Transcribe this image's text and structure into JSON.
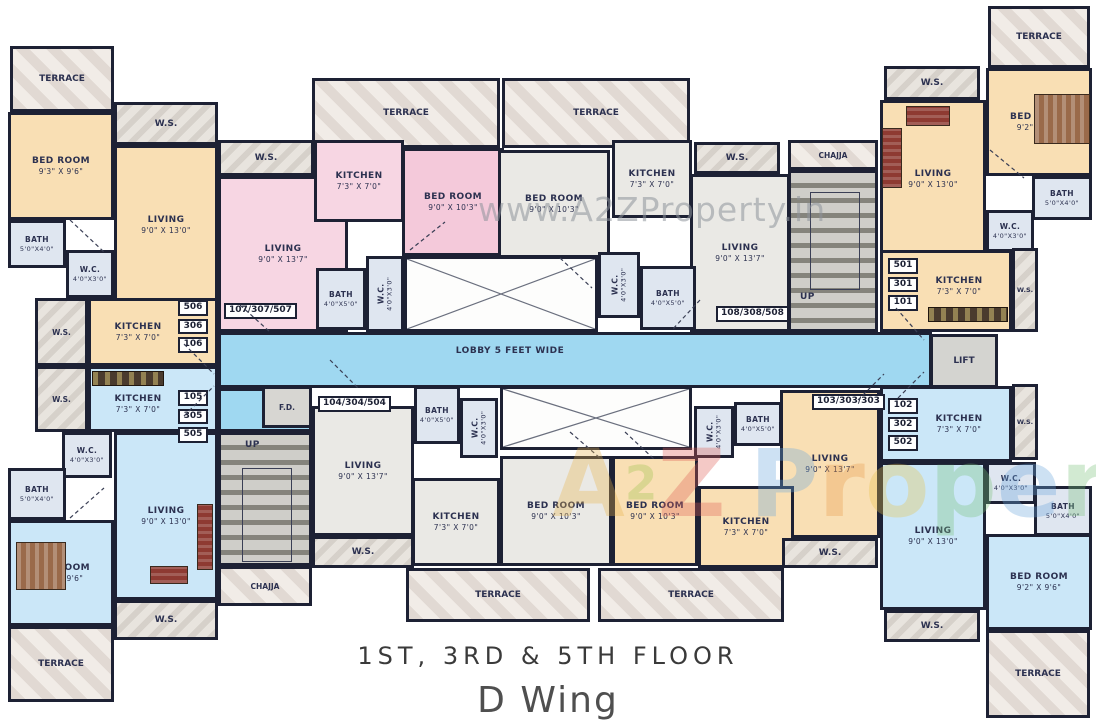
{
  "caption": {
    "floors": "1ST, 3RD & 5TH FLOOR",
    "wing": "D Wing"
  },
  "watermark": {
    "top": "www.A2ZProperty.in",
    "letters": [
      {
        "ch": "A",
        "style": "color:#e7b34b"
      },
      {
        "ch": "2",
        "style": "color:#9cc24b;font-size:0.5em;vertical-align:0.35em"
      },
      {
        "ch": "Z",
        "style": "color:#de5f55"
      },
      {
        "ch": "P",
        "style": "color:#6ba6dd;margin-left:24px"
      },
      {
        "ch": "r",
        "style": "color:#e79a4b"
      },
      {
        "ch": "o",
        "style": "color:#e7c34b"
      },
      {
        "ch": "p",
        "style": "color:#79c179"
      },
      {
        "ch": "e",
        "style": "color:#6ba6dd"
      },
      {
        "ch": "r",
        "style": "color:#79c179"
      },
      {
        "ch": "t",
        "style": "color:#de5f55"
      },
      {
        "ch": "y",
        "style": "color:#e79a4b"
      }
    ]
  },
  "labels": {
    "terrace": "TERRACE",
    "ws": "W.S.",
    "up": "UP",
    "chajja": "CHAJJA",
    "fd": "F.D.",
    "lift": "LIFT",
    "lobby": "LOBBY 5 FEET WIDE"
  },
  "units": {
    "nw": {
      "stack": [
        "506",
        "306",
        "106"
      ]
    },
    "sw": {
      "stack": [
        "105",
        "305",
        "505"
      ]
    },
    "ne": {
      "stack": [
        "501",
        "301",
        "101"
      ]
    },
    "se": {
      "stack": [
        "102",
        "302",
        "502"
      ]
    },
    "top_left": "107/307/507",
    "top_right": "108/308/508",
    "bottom_left": "104/304/504",
    "bottom_right": "103/303/303"
  },
  "rooms": {
    "nw_bed": {
      "name": "BED ROOM",
      "dims": "9'3\" X 9'6\""
    },
    "nw_living": {
      "name": "LIVING",
      "dims": "9'0\" X 13'0\""
    },
    "nw_bath": {
      "name": "BATH",
      "dims": "5'0\"X4'0\""
    },
    "nw_wc": {
      "name": "W.C.",
      "dims": "4'0\"X3'0\""
    },
    "nw_kitchen": {
      "name": "KITCHEN",
      "dims": "7'3\" X 7'0\""
    },
    "sw_kitchen": {
      "name": "KITCHEN",
      "dims": "7'3\" X 7'0\""
    },
    "sw_wc": {
      "name": "W.C.",
      "dims": "4'0\"X3'0\""
    },
    "sw_bath": {
      "name": "BATH",
      "dims": "5'0\"X4'0\""
    },
    "sw_bed": {
      "name": "BED ROOM",
      "dims": "9'2\" X 9'6\""
    },
    "sw_living": {
      "name": "LIVING",
      "dims": "9'0\" X 13'0\""
    },
    "p_living": {
      "name": "LIVING",
      "dims": "9'0\" X 13'7\""
    },
    "p_kitchen": {
      "name": "KITCHEN",
      "dims": "7'3\" X 7'0\""
    },
    "p_bed": {
      "name": "BED ROOM",
      "dims": "9'0\" X 10'3\""
    },
    "p_bath": {
      "name": "BATH",
      "dims": "4'0\"X5'0\""
    },
    "p_wc": {
      "name": "W.C.",
      "dims": "4'0\"X3'0\""
    },
    "g_bed": {
      "name": "BED ROOM",
      "dims": "9'0\" X 10'3\""
    },
    "g_kitchen": {
      "name": "KITCHEN",
      "dims": "7'3\" X 7'0\""
    },
    "g_living": {
      "name": "LIVING",
      "dims": "9'0\" X 13'7\""
    },
    "g_wc": {
      "name": "W.C.",
      "dims": "4'0\"X3'0\""
    },
    "g_bath": {
      "name": "BATH",
      "dims": "4'0\"X5'0\""
    },
    "ne_living": {
      "name": "LIVING",
      "dims": "9'0\" X 13'0\""
    },
    "ne_bed": {
      "name": "BED ROOM",
      "dims": "9'2\" X 9'6\""
    },
    "ne_bath": {
      "name": "BATH",
      "dims": "5'0\"X4'0\""
    },
    "ne_wc": {
      "name": "W.C.",
      "dims": "4'0\"X3'0\""
    },
    "ne_kitchen": {
      "name": "KITCHEN",
      "dims": "7'3\" X 7'0\""
    },
    "se_kitchen": {
      "name": "KITCHEN",
      "dims": "7'3\" X 7'0\""
    },
    "se_wc": {
      "name": "W.C.",
      "dims": "4'0\"X3'0\""
    },
    "se_bath": {
      "name": "BATH",
      "dims": "5'0\"X4'0\""
    },
    "se_living": {
      "name": "LIVING",
      "dims": "9'0\" X 13'0\""
    },
    "se_bed": {
      "name": "BED ROOM",
      "dims": "9'2\" X 9'6\""
    },
    "bl_living": {
      "name": "LIVING",
      "dims": "9'0\" X 13'7\""
    },
    "bl_bath": {
      "name": "BATH",
      "dims": "4'0\"X5'0\""
    },
    "bl_wc": {
      "name": "W.C.",
      "dims": "4'0\"X3'0\""
    },
    "bl_kitchen": {
      "name": "KITCHEN",
      "dims": "7'3\" X 7'0\""
    },
    "bl_bed": {
      "name": "BED ROOM",
      "dims": "9'0\" X 10'3\""
    },
    "br_living": {
      "name": "LIVING",
      "dims": "9'0\" X 13'7\""
    },
    "br_bath": {
      "name": "BATH",
      "dims": "4'0\"X5'0\""
    },
    "br_wc": {
      "name": "W.C.",
      "dims": "4'0\"X3'0\""
    },
    "br_bed": {
      "name": "BED ROOM",
      "dims": "9'0\" X 10'3\""
    },
    "br_kitchen": {
      "name": "KITCHEN",
      "dims": "7'3\" X 7'0\""
    }
  },
  "colors": {
    "wall": "#1d2134",
    "flat_orange": "#f9dfb4",
    "flat_blue": "#cbe7f8",
    "flat_pink": "#f7d6e3",
    "flat_gray": "#eae9e5",
    "lobby": "#9fd8f1"
  }
}
